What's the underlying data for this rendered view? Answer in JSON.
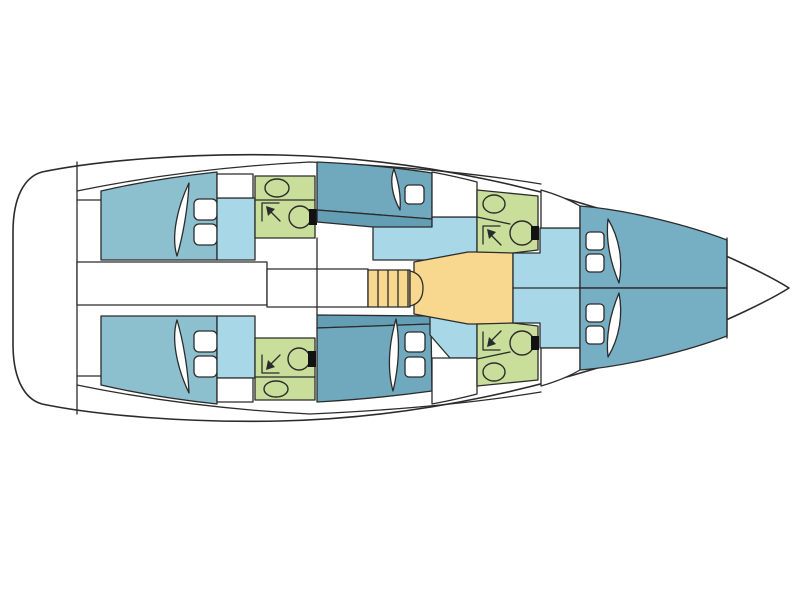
{
  "diagram": {
    "type": "yacht-deck-plan",
    "view": "top-down",
    "bow_direction": "right",
    "features": {
      "aft_cabins": 2,
      "mid_cabins": 2,
      "bow_cabins": 2,
      "bathrooms": 4,
      "companionway_steps": 1,
      "bathroom_icons": [
        "sink-icon",
        "toilet-icon",
        "shower-arrow-icon"
      ],
      "cabin_icons": [
        "mattress-blade",
        "pillow-hatch"
      ]
    }
  },
  "colors": {
    "background": "#ffffff",
    "hull": "#ffffff",
    "outline": "#2b2b2b",
    "cabin_aft": "#8cc0ce",
    "cabin_mid": "#70a9be",
    "cabin_mid_shade": "#639eb4",
    "cabin_bow": "#76afc3",
    "passage": "#a8d8e8",
    "bathroom": "#c8de9a",
    "stairs": "#f8d88f",
    "fixture_dark": "#121212"
  }
}
